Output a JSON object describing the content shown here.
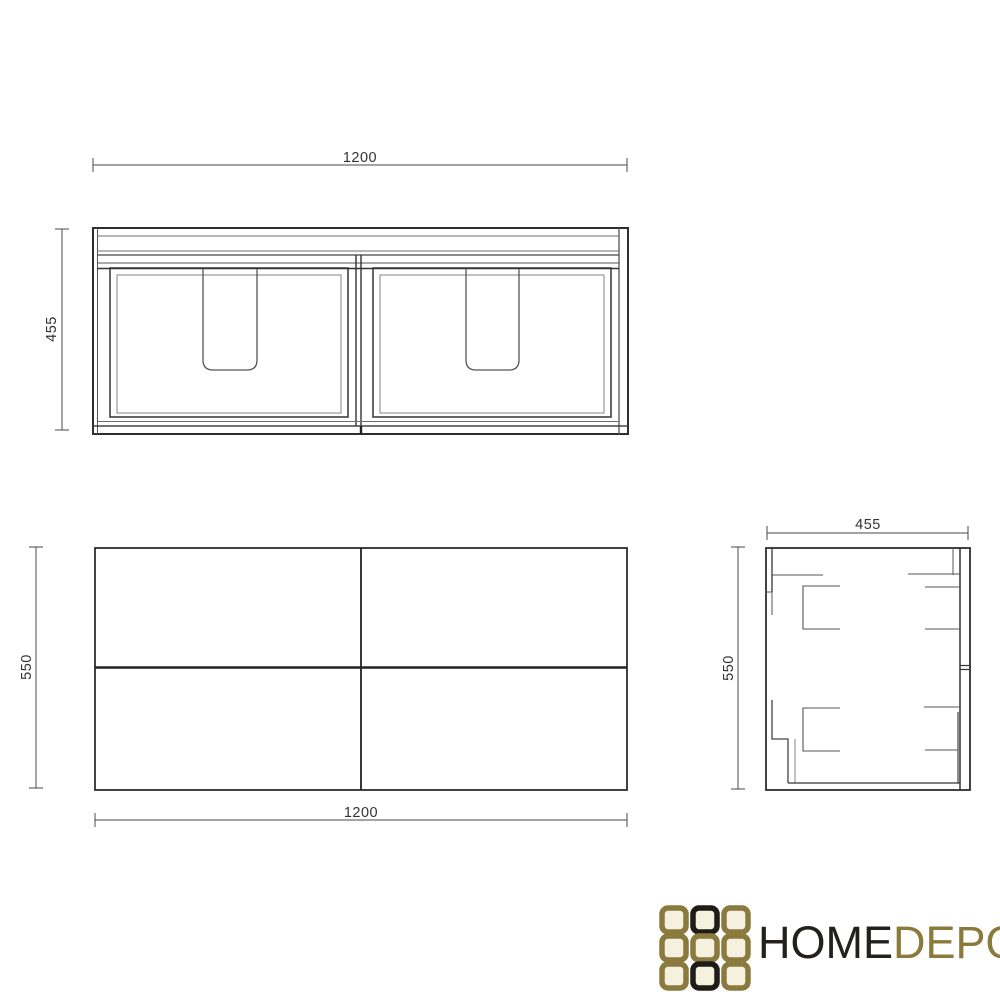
{
  "views": {
    "front": {
      "width_dim": "1200",
      "height_dim": "455"
    },
    "plan": {
      "width_dim": "1200",
      "height_dim": "550"
    },
    "side": {
      "width_dim": "455",
      "height_dim": "550"
    }
  },
  "logo": {
    "word_primary": "HOME",
    "word_secondary": "DEPO"
  },
  "colors": {
    "line_dark": "#2e2e2e",
    "line_medium": "#555555",
    "line_light": "#777777",
    "dim_line": "#4a4a4a",
    "dim_text": "#333333",
    "logo_gold": "#8a7a3e",
    "logo_black": "#1f1c18",
    "logo_square_fill": "#f6f0de",
    "background": "#ffffff"
  }
}
